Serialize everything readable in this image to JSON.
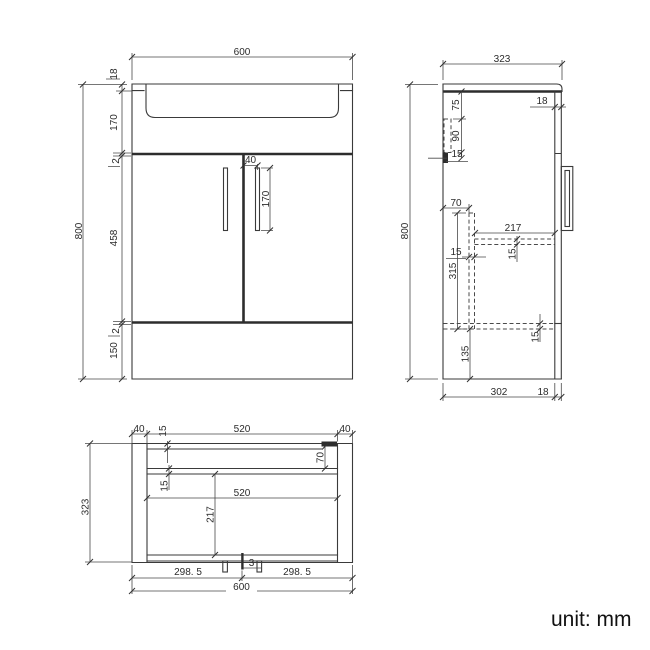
{
  "footer": {
    "unit_label": "unit: mm"
  },
  "front": {
    "width": "600",
    "height": "800",
    "chain": {
      "counter_thickness": "18",
      "basin_depth": "170",
      "gap_top": "2",
      "door_height": "458",
      "gap_bottom": "2",
      "plinth_height": "150"
    },
    "handle_offset": "40",
    "handle_length": "170"
  },
  "side": {
    "depth": "323",
    "height": "800",
    "front_panel_thickness": "18",
    "bracket_offset": "75",
    "bracket_height": "90",
    "bracket_foot": "15",
    "partition_offset": "70",
    "partition_height": "315",
    "partition_thickness": "15",
    "shelf_depth": "217",
    "shelf_thickness": "15",
    "bottom_panel_thickness": "15",
    "plinth_height": "135",
    "body_depth": "302",
    "door_thickness": "18"
  },
  "plan": {
    "left_panel": "40",
    "back_panel_thickness": "15",
    "inner_width": "520",
    "right_panel": "40",
    "depth": "323",
    "bracket_offset": "70",
    "rail_thickness": "15",
    "shelf_width": "520",
    "shelf_depth": "217",
    "door_gap": "3",
    "left_door_width": "298. 5",
    "right_door_width": "298. 5",
    "total_width": "600"
  }
}
